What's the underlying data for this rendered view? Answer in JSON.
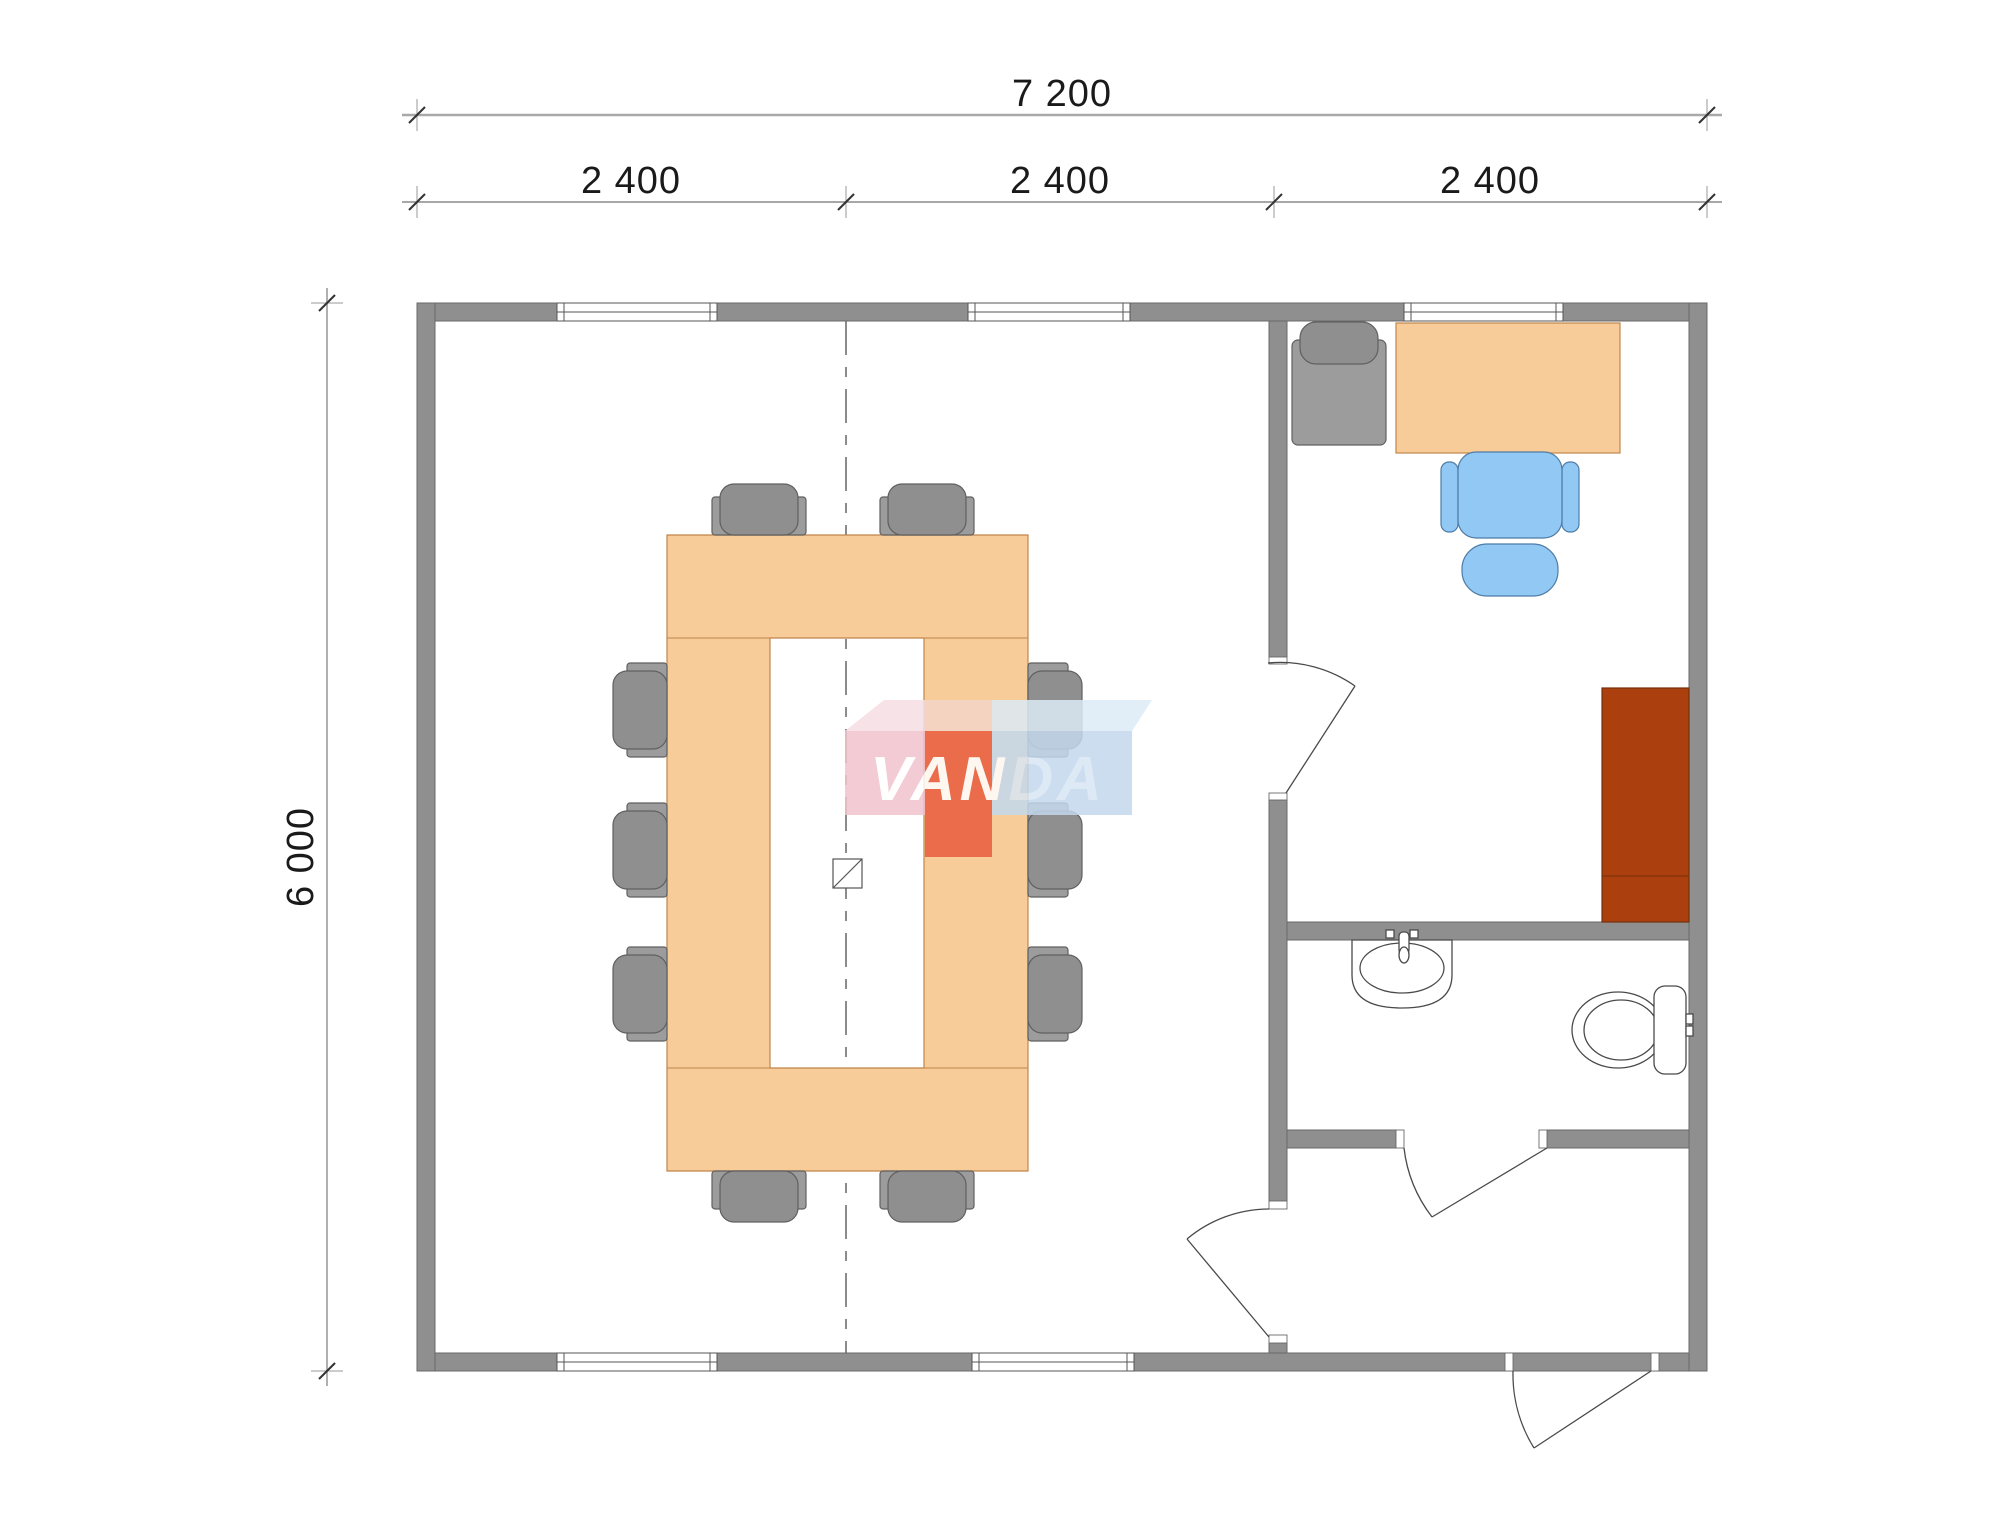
{
  "dimensions": {
    "overall_width_label": "7 200",
    "module_labels": [
      "2 400",
      "2 400",
      "2 400"
    ],
    "overall_height_label": "6 000"
  },
  "watermark": {
    "text_primary": "VAN",
    "text_secondary": "DA"
  },
  "colors": {
    "wall": "#8f8f8f",
    "dimension_text": "#1a1a1a",
    "table": "#f8cc99",
    "table_edge": "#c0854c",
    "chair_gray": "#9c9c9c",
    "chair_cushion": "#8f8f8f",
    "chair_blue": "#92c9f4",
    "cabinet": "#ab3f0e",
    "fixture_outline": "#4a4a4a",
    "watermark_pink": "#f2c2cd",
    "watermark_red": "#e85c3e",
    "watermark_blue": "#c3d8ed",
    "watermark_top_pink": "#f6dde3",
    "watermark_top_peach": "#f5d5c8",
    "watermark_top_blue": "#dcebf6",
    "watermark_letters_secondary": "#d8e6f4"
  }
}
